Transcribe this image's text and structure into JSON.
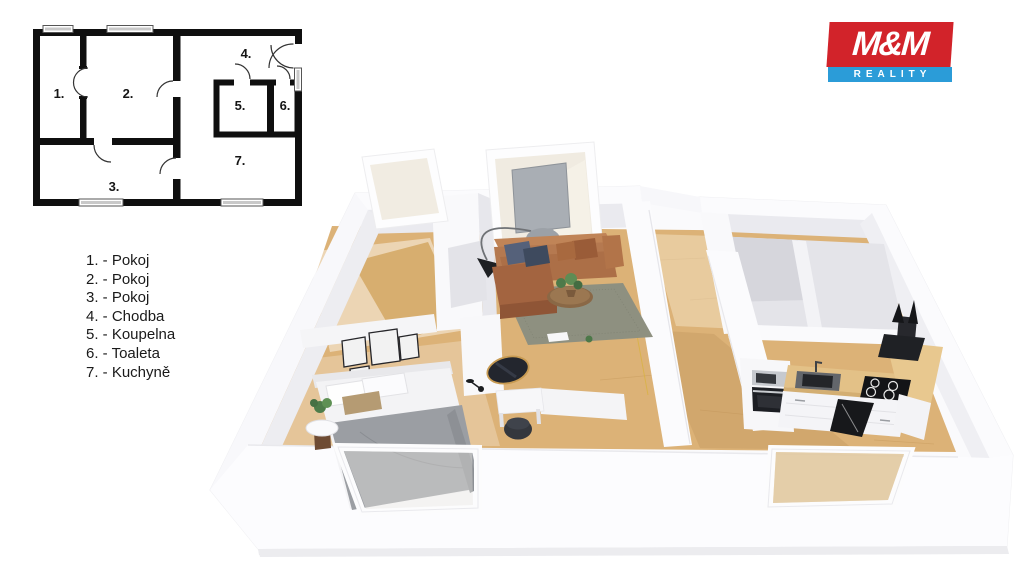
{
  "plan2d": {
    "room_numbers": [
      "1.",
      "2.",
      "3.",
      "4.",
      "5.",
      "6.",
      "7."
    ]
  },
  "legend": {
    "items": [
      "1. - Pokoj",
      "2. - Pokoj",
      "3. - Pokoj",
      "4. - Chodba",
      "5. - Koupelna",
      "6. - Toaleta",
      "7. - Kuchyně"
    ]
  },
  "logo": {
    "name": "M&M",
    "tagline": "REALITY",
    "red": "#d2232a",
    "blue": "#2b9cd8"
  },
  "colors": {
    "wall_white": "#fbfbfd",
    "wall_shade": "#eaeaef",
    "floor_wood": "#dcb277",
    "rug": "#8e9080",
    "sofa": "#b57950",
    "bed_blanket": "#9b9ea3",
    "counter_wood": "#e3c187",
    "appliance_black": "#1c1e23"
  }
}
